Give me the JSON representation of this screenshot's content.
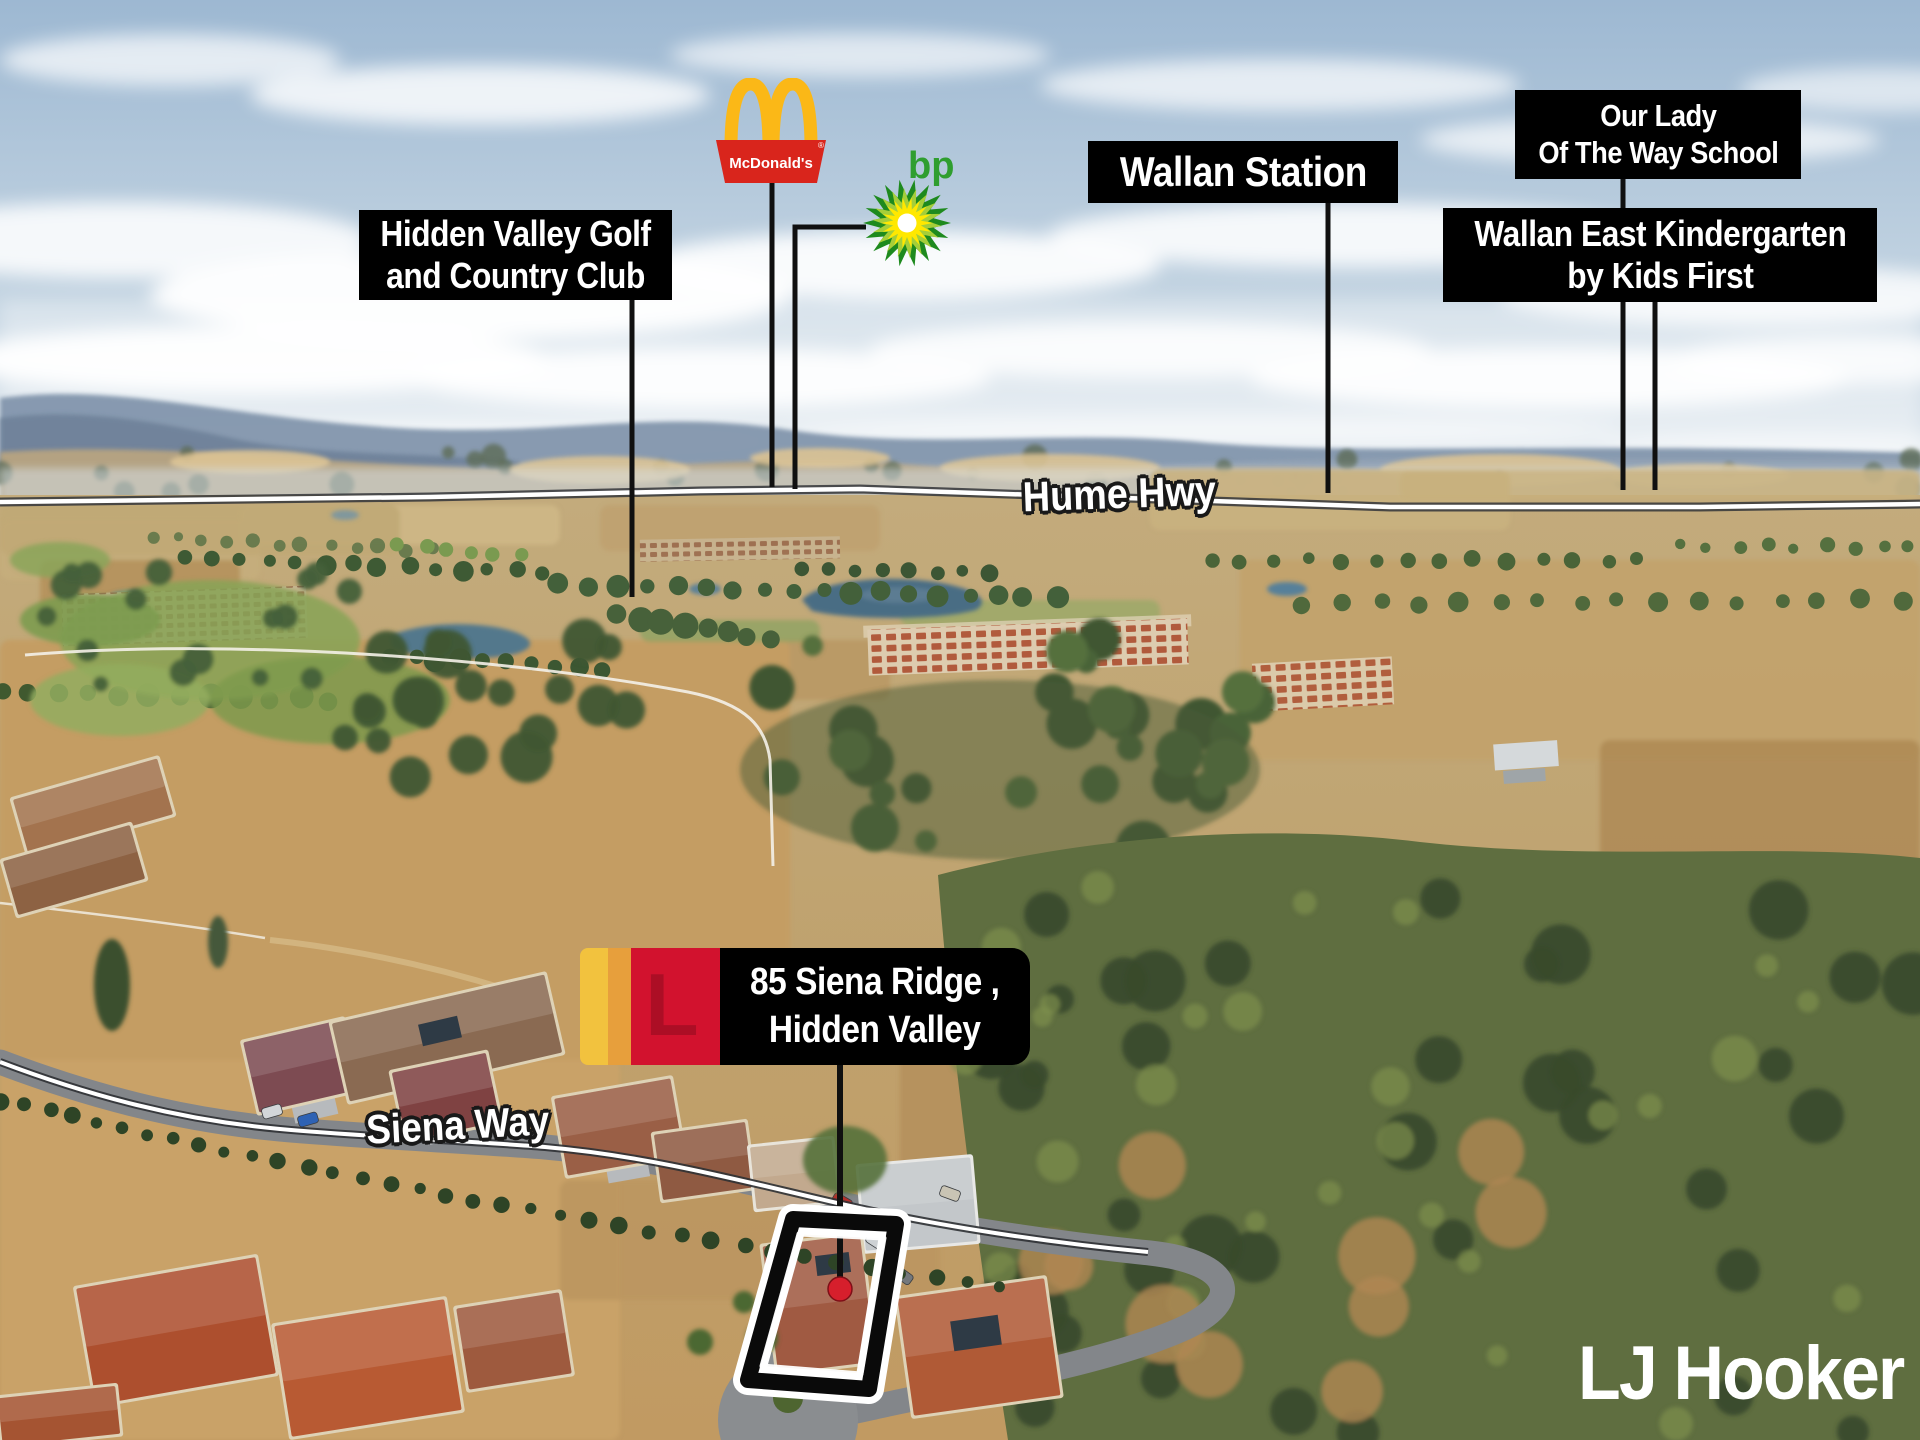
{
  "labels": {
    "golf_club": {
      "line1": "Hidden Valley Golf",
      "line2": "and Country Club"
    },
    "station": {
      "text": "Wallan Station"
    },
    "school": {
      "line1": "Our Lady",
      "line2": "Of The Way School"
    },
    "kindergarten": {
      "line1": "Wallan East Kindergarten",
      "line2": "by Kids First"
    },
    "property": {
      "line1": "85 Siena Ridge ,",
      "line2": "Hidden Valley"
    }
  },
  "roads": {
    "highway": "Hume Hwy",
    "street": "Siena Way"
  },
  "logos": {
    "mcdonalds": {
      "sign_text": "McDonald's",
      "registered_mark": "®"
    },
    "bp": {
      "wordmark": "bp"
    },
    "agency": {
      "wordmark": "LJ Hooker",
      "monogram_letter": "L"
    }
  },
  "colors": {
    "label_bg": "#000000",
    "label_text": "#ffffff",
    "mcdonalds_red": "#d9251c",
    "mcdonalds_gold": "#fbb817",
    "bp_dark_green": "#1e8a1e",
    "bp_mid_green": "#a5ce39",
    "bp_yellow": "#ffe800",
    "bp_text_green": "#2f9e2f",
    "lj_gold": "#f2c23e",
    "lj_amber": "#e79f3c",
    "lj_red": "#d2122e",
    "marker_red": "#d61f2c",
    "leader_line": "#101010",
    "road_line_white": "#ffffff"
  }
}
